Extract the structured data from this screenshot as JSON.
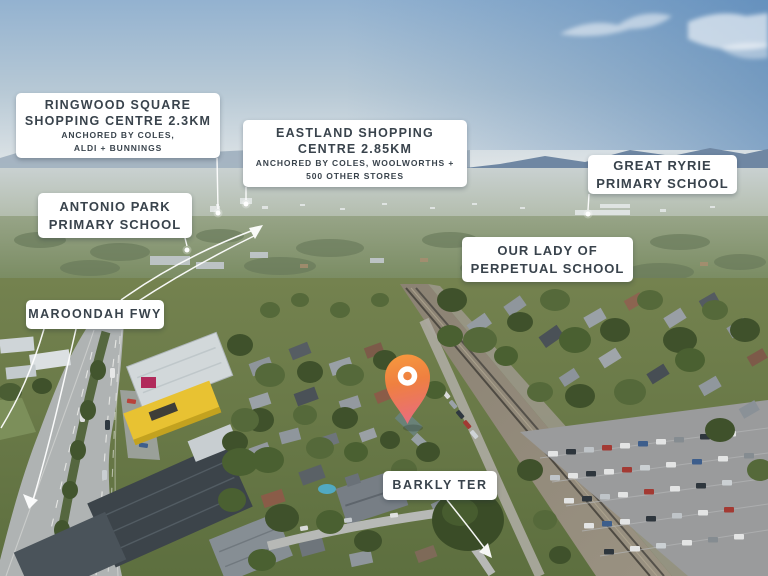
{
  "image": {
    "description": "Aerial drone photograph of a suburb with real-estate location callouts and a property pin",
    "pin_color_top": "#F79A3E",
    "pin_color_mid": "#EF8040",
    "pin_color_bottom": "#E96E79",
    "label_bg": "#FFFFFF",
    "label_text_color": "#39434C",
    "annotation_color": "#FFFFFF"
  },
  "labels": {
    "ringwood": {
      "title1": "RINGWOOD SQUARE",
      "title2": "SHOPPING CENTRE 2.3KM",
      "sub1": "ANCHORED BY COLES,",
      "sub2": "ALDI + BUNNINGS"
    },
    "eastland": {
      "title1": "EASTLAND SHOPPING",
      "title2": "CENTRE 2.85KM",
      "sub1": "ANCHORED BY COLES, WOOLWORTHS +",
      "sub2": "500 OTHER STORES"
    },
    "great_ryrie": {
      "line1": "GREAT RYRIE",
      "line2": "PRIMARY SCHOOL"
    },
    "antonio_park": {
      "line1": "ANTONIO PARK",
      "line2": "PRIMARY SCHOOL"
    },
    "our_lady": {
      "line1": "OUR LADY OF",
      "line2": "PERPETUAL SCHOOL"
    },
    "maroondah_fwy": {
      "line1": "MAROONDAH FWY"
    },
    "barkly_ter": {
      "line1": "BARKLY TER"
    }
  }
}
